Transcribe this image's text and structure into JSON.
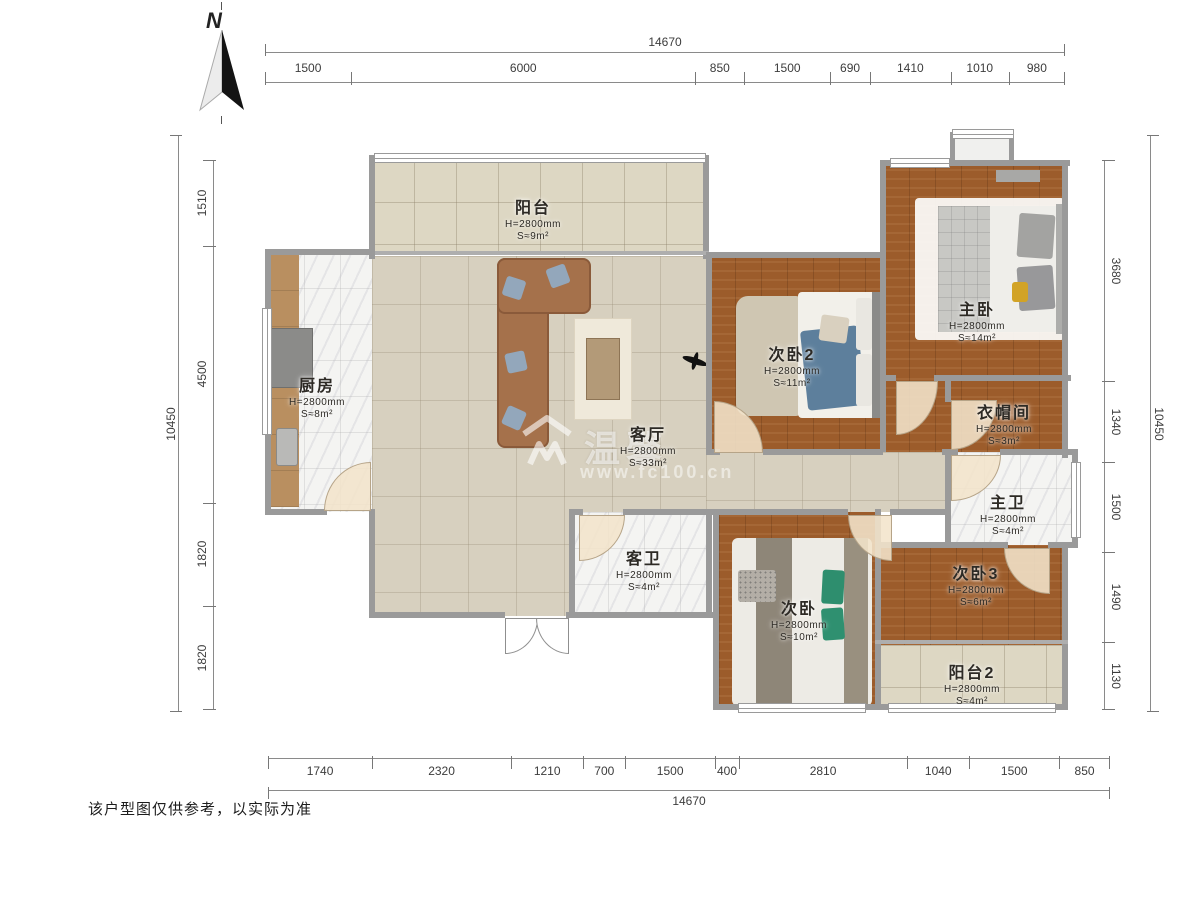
{
  "north": {
    "label": "N"
  },
  "watermark": {
    "brand": "温馨",
    "url": "www.fc100.cn"
  },
  "disclaimer": "该户型图仅供参考，以实际为准",
  "dims": {
    "top": {
      "total": "14670",
      "segments": [
        "1500",
        "6000",
        "850",
        "1500",
        "690",
        "1410",
        "1010",
        "980"
      ]
    },
    "bottom": {
      "total": "14670",
      "segments": [
        "1740",
        "2320",
        "1210",
        "700",
        "1500",
        "400",
        "2810",
        "1040",
        "1500",
        "850"
      ]
    },
    "left": {
      "total": "10450",
      "segments": [
        "1510",
        "4500",
        "1820",
        "1820"
      ]
    },
    "right": {
      "total": "10450",
      "segments": [
        "3680",
        "1340",
        "1500",
        "1490",
        "1130"
      ]
    }
  },
  "rooms": {
    "yangtai": {
      "name": "阳台",
      "h": "H=2800mm",
      "s": "S≈9m²"
    },
    "chufang": {
      "name": "厨房",
      "h": "H=2800mm",
      "s": "S≈8m²"
    },
    "keting": {
      "name": "客厅",
      "h": "H=2800mm",
      "s": "S≈33m²"
    },
    "ciwo2": {
      "name": "次卧2",
      "h": "H=2800mm",
      "s": "S≈11m²"
    },
    "zhuwo": {
      "name": "主卧",
      "h": "H=2800mm",
      "s": "S≈14m²"
    },
    "yimaojian": {
      "name": "衣帽间",
      "h": "H=2800mm",
      "s": "S≈3m²"
    },
    "zhuwei": {
      "name": "主卫",
      "h": "H=2800mm",
      "s": "S≈4m²"
    },
    "kewei": {
      "name": "客卫",
      "h": "H=2800mm",
      "s": "S≈4m²"
    },
    "ciwo": {
      "name": "次卧",
      "h": "H=2800mm",
      "s": "S≈10m²"
    },
    "ciwo3": {
      "name": "次卧3",
      "h": "H=2800mm",
      "s": "S≈6m²"
    },
    "yangtai2": {
      "name": "阳台2",
      "h": "H=2800mm",
      "s": "S≈4m²"
    }
  },
  "colors": {
    "wall": "#9a9a9a",
    "wood_floor": "#9c5c2b",
    "tile_floor": "#d7d0bf",
    "balcony_tile": "#ddd7c3",
    "marble_floor": "#f4f4f2",
    "sofa_brown": "#a5714b",
    "accent_blue": "#5d7f9c",
    "accent_green": "#2e8e6e",
    "accent_yellow": "#d2a326"
  }
}
